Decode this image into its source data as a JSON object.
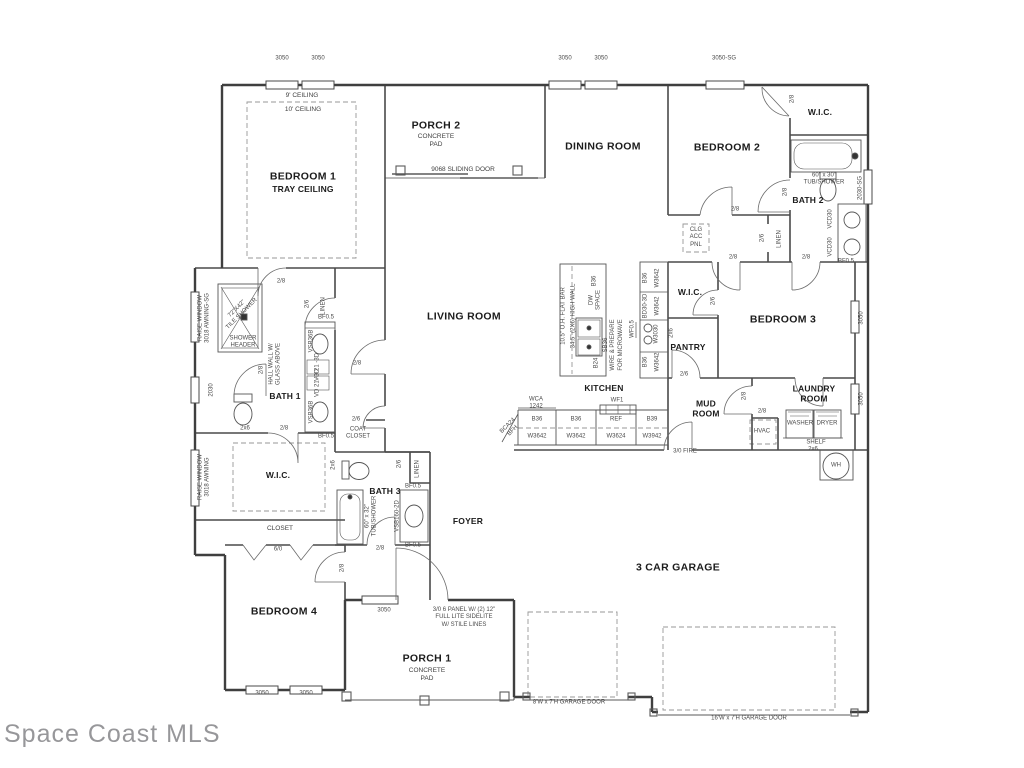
{
  "watermark": "Space Coast MLS",
  "rooms": {
    "bedroom1": "BEDROOM 1",
    "bedroom1_sub": "TRAY CEILING",
    "porch2": "PORCH 2",
    "porch2_sub": "CONCRETE\nPAD",
    "dining": "DINING ROOM",
    "bedroom2": "BEDROOM 2",
    "wic_top": "W.I.C.",
    "bath2": "BATH 2",
    "bedroom3": "BEDROOM 3",
    "wic_mid": "W.I.C.",
    "pantry": "PANTRY",
    "living": "LIVING ROOM",
    "kitchen": "KITCHEN",
    "mud": "MUD\nROOM",
    "laundry": "LAUNDRY\nROOM",
    "bath1": "BATH 1",
    "wic_master": "W.I.C.",
    "bath3": "BATH 3",
    "foyer": "FOYER",
    "garage": "3 CAR GARAGE",
    "bedroom4": "BEDROOM 4",
    "porch1": "PORCH 1",
    "porch1_sub": "CONCRETE\nPAD"
  },
  "notes": {
    "ceiling9": "9' CEILING",
    "ceiling10": "10' CEILING",
    "sliding": "9068 SLIDING DOOR",
    "tub2": "60\" x 30\"\nTUB/SHOWER",
    "clgacc": "CLG\nACC\nPNL",
    "linen_b2": "LINEN",
    "linen_b1": "LINEN",
    "linen_b3": "LINEN",
    "tileshower": "72\"X42\"\nTILE SHOWER",
    "showerheader": "SHOWER\nHEADER",
    "hallwall": "HALL WALL W/\nGLASS ABOVE",
    "coat": "COAT\nCLOSET",
    "closet": "CLOSET",
    "tub3": "60\" x 32\"\nTUB/SHOWER",
    "vsb160": "VSB160-2D",
    "bf05_c": "BF0.5",
    "bf05_d": "BF0.5",
    "entrynote": "3/0 6 PANEL W/ (2) 12\"\nFULL LITE SIDELITE\nW/ STILE LINES",
    "gd8": "8'W x 7'H GARAGE DOOR",
    "gd16": "16'W x 7'H GARAGE DOOR",
    "fire": "3/0 FIRE",
    "hvac": "HVAC",
    "washer": "WASHER",
    "dryer": "DRYER",
    "shelf": "SHELF",
    "shelf2x6": "2x6",
    "wh": "WH",
    "raise1": "RAISE WINDOW\n3018 AWNING-SG",
    "raise2": "RAISE WINDOW\n3018 AWNING",
    "w2030": "2030",
    "sg2030": "2030-SG",
    "r3050a": "3050",
    "r3050b": "3050"
  },
  "cabinets": {
    "wca": "WCA\n1242",
    "wf1": "WF1",
    "b36_1": "B36",
    "w3642_1": "W3642",
    "b36_2": "B36",
    "w3642_2": "W3642",
    "ref": "REF",
    "w3624": "W3624",
    "b39": "B39",
    "w3942": "W3942",
    "bca24": "BCA24\nBFH",
    "flatbar": "10.5\" O.H. FLAT BAR",
    "highwall": "34.5\" (2X6) HIGH WALL",
    "b36_i": "B36",
    "dw": "DW\nSPACE",
    "sb36": "SB36\nWIRE & PREPARE\nFOR MICROWAVE",
    "b24": "B24",
    "b36_3": "B36",
    "w3642_3": "W3642",
    "bd30": "BD30-3D",
    "w3642_4": "W3642",
    "wf05": "WF0.5",
    "w3030": "W3030",
    "c2x6_a": "2x6",
    "b36_4": "B36",
    "w3642_5": "W3642",
    "bf05_a": "BF0.5",
    "vsb36b_1": "VSB36B",
    "vd1": "VD 21 -3D",
    "vd2": "VD 21 -3D",
    "vsb36b_2": "VSB36B",
    "bf05_b": "BF0.5",
    "vcd30_1": "VCD30",
    "vcd30_2": "VCD30",
    "bf05_e": "BF0.5"
  },
  "dims": {
    "t1": "3050",
    "t2": "3050",
    "t3": "3050",
    "t4": "3050",
    "t5": "3050-SG",
    "b1": "3050",
    "b2": "3050",
    "p1": "3050",
    "d60": "6/0"
  },
  "doors": {
    "d28a": "2/8",
    "d28b": "2/8",
    "d28c": "2/8",
    "d26a": "2/6",
    "d28d": "2/8",
    "d28e": "2/8",
    "d26b": "2/6",
    "d26c": "2/6",
    "d28f": "2/8",
    "d28g": "2/8",
    "d28h": "2/8",
    "d26d": "2/6",
    "d28i": "2/8",
    "d28j": "2/8",
    "c2x6_b": "2x6",
    "d28k": "2/8",
    "d26e": "2/6",
    "d28l": "2/8",
    "d28m": "2/8",
    "d26f": "2/6",
    "c2x6_c": "2x6"
  }
}
